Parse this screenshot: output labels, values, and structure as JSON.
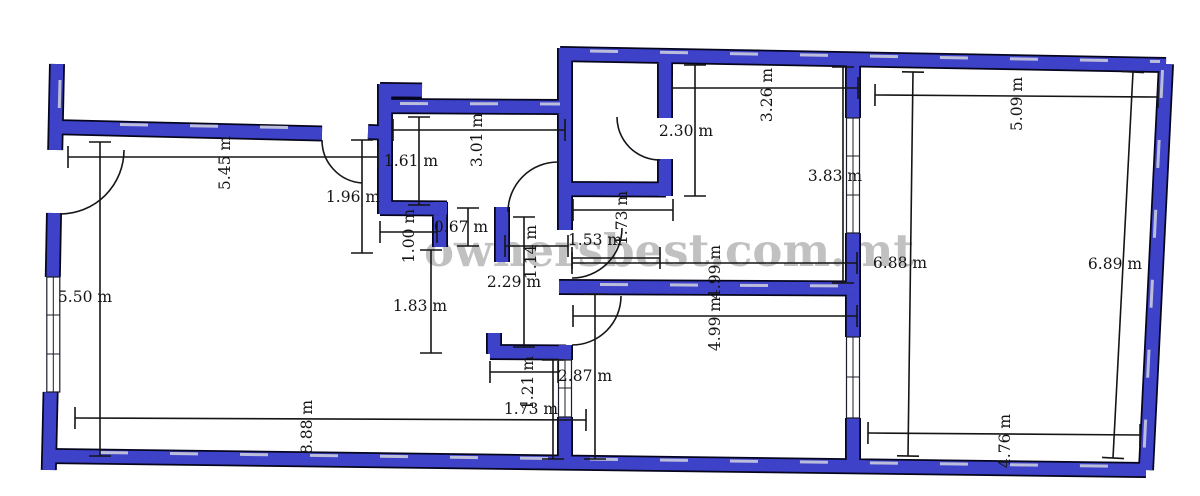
{
  "watermark": {
    "text": "ownersbest.com.mt"
  },
  "units": "m",
  "colors": {
    "wall": "#3d42c9",
    "wall_outline": "#05051e",
    "wall_highlight": "#c9cbdd",
    "dimension_text": "#151515",
    "watermark": "#8f8f8f",
    "background": "#ffffff"
  },
  "plan": {
    "type": "apartment-floor-plan",
    "dimensions": [
      {
        "label": "5.45 m",
        "value": 5.45,
        "rotated": true,
        "tx": 225,
        "ty": 163,
        "x1": 68,
        "y1": 157,
        "x2": 378,
        "y2": 157
      },
      {
        "label": "5.50 m",
        "value": 5.5,
        "rotated": false,
        "tx": 85,
        "ty": 297,
        "x1": 100,
        "y1": 142,
        "x2": 100,
        "y2": 456
      },
      {
        "label": "1.61 m",
        "value": 1.61,
        "rotated": false,
        "tx": 411,
        "ty": 161,
        "x1": 419,
        "y1": 117,
        "x2": 419,
        "y2": 205
      },
      {
        "label": "3.01 m",
        "value": 3.01,
        "rotated": true,
        "tx": 477,
        "ty": 140,
        "x1": 393,
        "y1": 130,
        "x2": 565,
        "y2": 130
      },
      {
        "label": "1.96 m",
        "value": 1.96,
        "rotated": false,
        "tx": 353,
        "ty": 197,
        "x1": 362,
        "y1": 140,
        "x2": 362,
        "y2": 253
      },
      {
        "label": "1.00 m",
        "value": 1.0,
        "rotated": true,
        "tx": 409,
        "ty": 236,
        "x1": 380,
        "y1": 232,
        "x2": 437,
        "y2": 232
      },
      {
        "label": "0.67 m",
        "value": 0.67,
        "rotated": false,
        "tx": 461,
        "ty": 227,
        "x1": 468,
        "y1": 208,
        "x2": 468,
        "y2": 246
      },
      {
        "label": "1.14 m",
        "value": 1.14,
        "rotated": true,
        "tx": 531,
        "ty": 252,
        "x1": 505,
        "y1": 246,
        "x2": 568,
        "y2": 246
      },
      {
        "label": "1.53 m",
        "value": 1.53,
        "rotated": false,
        "tx": 595,
        "ty": 240,
        "x1": 572,
        "y1": 258,
        "x2": 660,
        "y2": 258
      },
      {
        "label": "2.29 m",
        "value": 2.29,
        "rotated": false,
        "tx": 514,
        "ty": 282,
        "x1": 524,
        "y1": 217,
        "x2": 524,
        "y2": 347
      },
      {
        "label": "1.83 m",
        "value": 1.83,
        "rotated": false,
        "tx": 420,
        "ty": 306,
        "x1": 431,
        "y1": 250,
        "x2": 431,
        "y2": 353
      },
      {
        "label": "2.30 m",
        "value": 2.3,
        "rotated": false,
        "tx": 686,
        "ty": 131,
        "x1": 695,
        "y1": 65,
        "x2": 695,
        "y2": 196
      },
      {
        "label": "1.73 m",
        "value": 1.73,
        "rotated": true,
        "tx": 622,
        "ty": 218,
        "x1": 573,
        "y1": 210,
        "x2": 673,
        "y2": 210
      },
      {
        "label": "3.26 m",
        "value": 3.26,
        "rotated": true,
        "tx": 767,
        "ty": 95,
        "x1": 672,
        "y1": 88,
        "x2": 858,
        "y2": 88
      },
      {
        "label": "3.83 m",
        "value": 3.83,
        "rotated": false,
        "tx": 835,
        "ty": 176,
        "x1": 843,
        "y1": 67,
        "x2": 843,
        "y2": 283
      },
      {
        "label": "4.99 m",
        "value": 4.99,
        "rotated": true,
        "tx": 715,
        "ty": 272,
        "x1": 572,
        "y1": 263,
        "x2": 857,
        "y2": 263
      },
      {
        "label": "4.99 m",
        "value": 4.99,
        "rotated": true,
        "tx": 715,
        "ty": 324,
        "x1": 573,
        "y1": 316,
        "x2": 857,
        "y2": 316
      },
      {
        "label": "1.21 m",
        "value": 1.21,
        "rotated": true,
        "tx": 528,
        "ty": 383,
        "x1": 490,
        "y1": 372,
        "x2": 558,
        "y2": 372
      },
      {
        "label": "1.73 m",
        "value": 1.73,
        "rotated": false,
        "tx": 531,
        "ty": 409,
        "x1": 553,
        "y1": 360,
        "x2": 553,
        "y2": 459
      },
      {
        "label": "2.87 m",
        "value": 2.87,
        "rotated": false,
        "tx": 585,
        "ty": 376,
        "x1": 595,
        "y1": 294,
        "x2": 595,
        "y2": 459
      },
      {
        "label": "8.88 m",
        "value": 8.88,
        "rotated": true,
        "tx": 307,
        "ty": 427,
        "x1": 75,
        "y1": 418,
        "x2": 586,
        "y2": 420
      },
      {
        "label": "6.88 m",
        "value": 6.88,
        "rotated": false,
        "tx": 900,
        "ty": 263,
        "x1": 913,
        "y1": 72,
        "x2": 908,
        "y2": 456
      },
      {
        "label": "6.89 m",
        "value": 6.89,
        "rotated": false,
        "tx": 1115,
        "ty": 264,
        "x1": 1133,
        "y1": 72,
        "x2": 1113,
        "y2": 458
      },
      {
        "label": "5.09 m",
        "value": 5.09,
        "rotated": true,
        "tx": 1017,
        "ty": 104,
        "x1": 875,
        "y1": 95,
        "x2": 1158,
        "y2": 97
      },
      {
        "label": "4.76 m",
        "value": 4.76,
        "rotated": true,
        "tx": 1005,
        "ty": 441,
        "x1": 868,
        "y1": 433,
        "x2": 1140,
        "y2": 435
      }
    ]
  }
}
